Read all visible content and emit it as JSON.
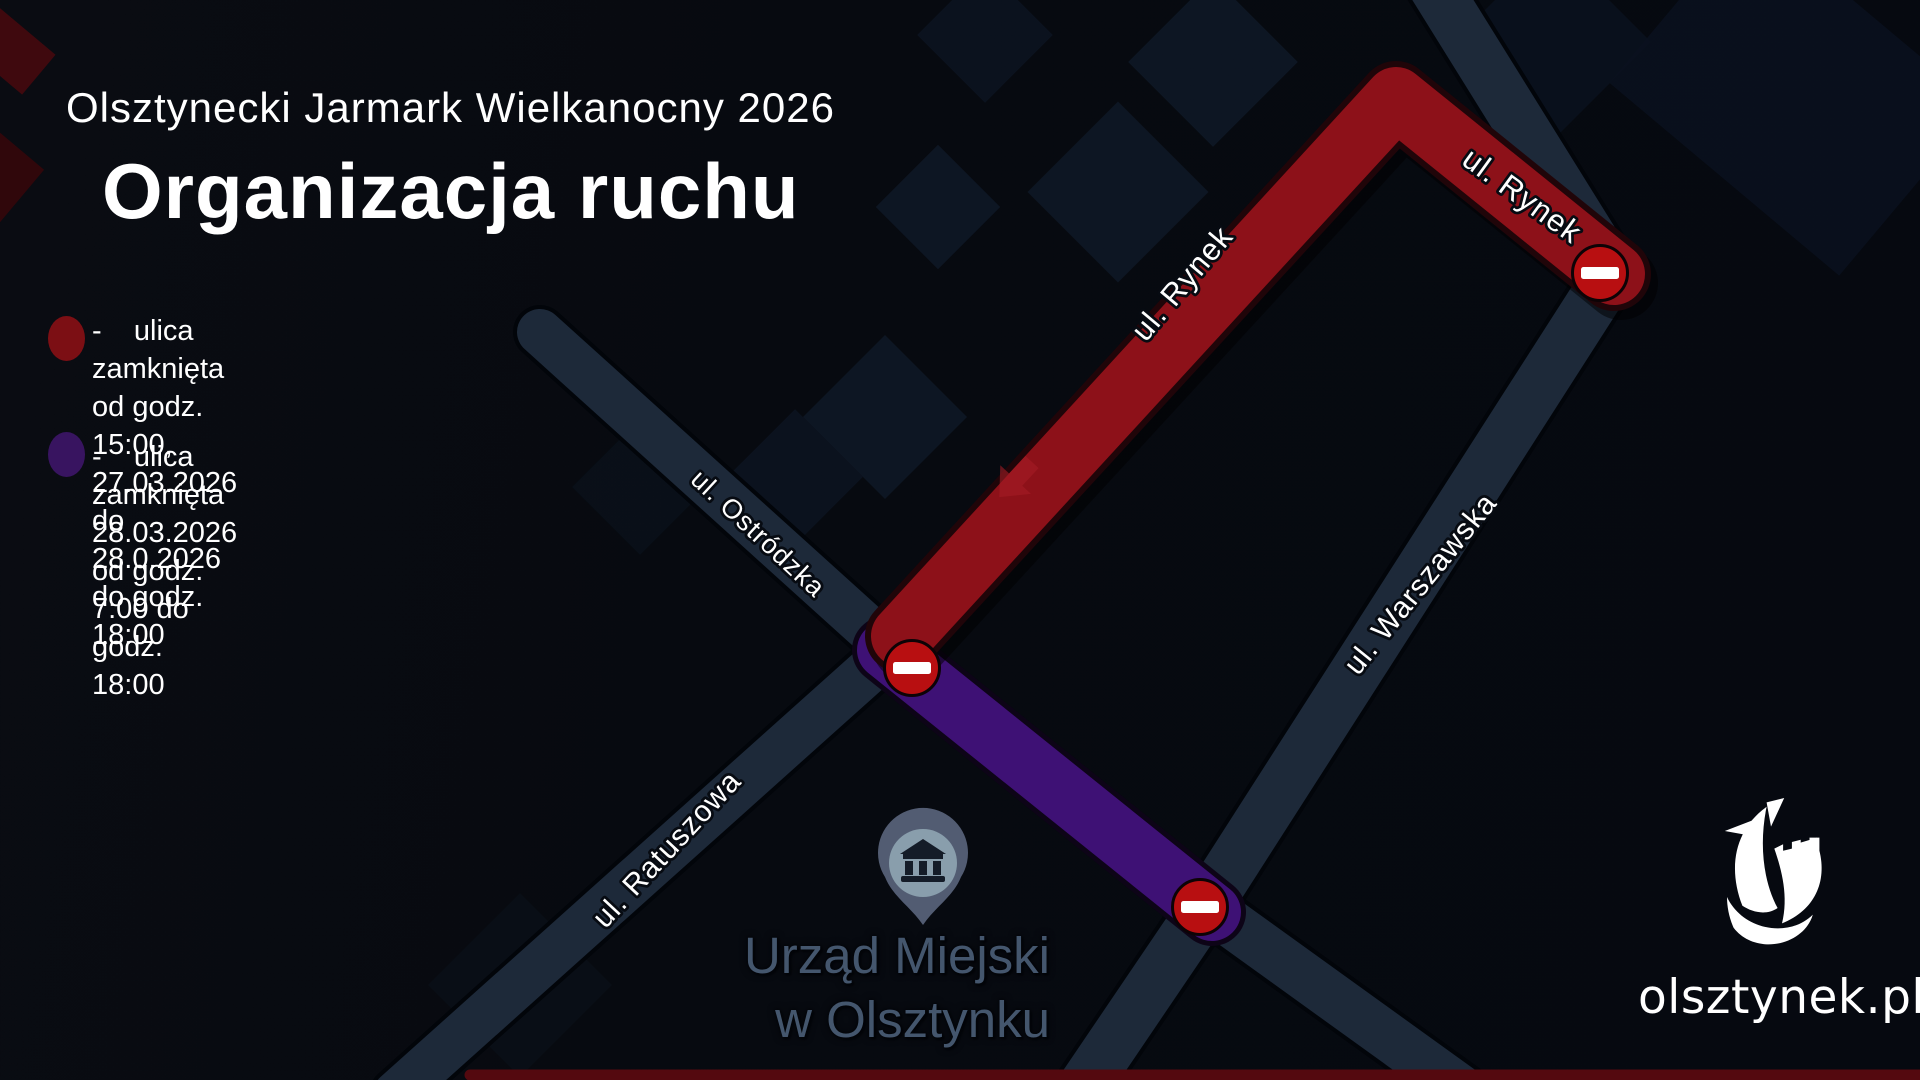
{
  "header": {
    "subtitle": "Olsztynecki Jarmark Wielkanocny 2026",
    "title": "Organizacja ruchu"
  },
  "legend": {
    "items": [
      {
        "color": "#7c0f14",
        "line1": "-    ulica zamknięta od godz. 15:00, 27.03.2026",
        "line2": "do 28.0.2026 do godz. 18:00"
      },
      {
        "color": "#381460",
        "line1": "-    ulica zamknięta  28.03.2026",
        "line2": "od godz. 7:00 do godz. 18:00"
      }
    ]
  },
  "map": {
    "street_labels": [
      {
        "text": "ul. Rynek"
      },
      {
        "text": "ul. Rynek"
      },
      {
        "text": "ul. Ostródzka"
      },
      {
        "text": "ul. Ratuszowa"
      },
      {
        "text": "ul. Warszawska"
      }
    ],
    "poi": {
      "line1": "Urząd Miejski",
      "line2": "w Olsztynku"
    },
    "colors": {
      "closed_red": "#8d1119",
      "closed_red_outline": "#200509",
      "closed_purple": "#3e1175",
      "closed_purple_outline": "#0d0417",
      "road_navy": "#1d2939",
      "road_navy_outline": "#02050a",
      "no_entry_red": "#b80f11",
      "bottom_strip_red": "#54090f"
    },
    "icons": {
      "no_entry": "no-entry-icon",
      "museum": "museum-building-icon",
      "direction_arrow": "direction-arrow-icon",
      "logo_mark": "olsztynek-logo-mark"
    }
  },
  "logo": {
    "text": "olsztynek.pl"
  }
}
